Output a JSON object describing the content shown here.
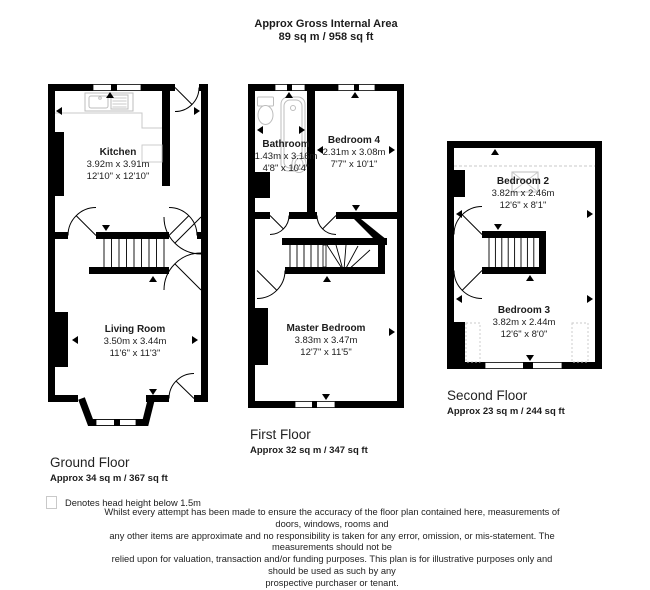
{
  "header": {
    "title": "Approx Gross Internal Area",
    "subtitle": "89 sq m / 958 sq ft"
  },
  "floors": [
    {
      "label": "Ground Floor",
      "area": "Approx 34 sq m / 367 sq ft",
      "rooms": [
        {
          "name": "Kitchen",
          "metric": "3.92m x 3.91m",
          "imperial": "12'10\" x 12'10\""
        },
        {
          "name": "Living Room",
          "metric": "3.50m x 3.44m",
          "imperial": "11'6\" x 11'3\""
        }
      ]
    },
    {
      "label": "First Floor",
      "area": "Approx 32 sq m / 347 sq ft",
      "rooms": [
        {
          "name": "Bathroom",
          "metric": "1.43m x 3.16m",
          "imperial": "4'8\" x 10'4\""
        },
        {
          "name": "Bedroom 4",
          "metric": "2.31m x 3.08m",
          "imperial": "7'7\" x 10'1\""
        },
        {
          "name": "Master Bedroom",
          "metric": "3.83m x 3.47m",
          "imperial": "12'7\" x 11'5\""
        }
      ]
    },
    {
      "label": "Second Floor",
      "area": "Approx 23 sq m / 244 sq ft",
      "rooms": [
        {
          "name": "Bedroom 2",
          "metric": "3.82m x 2.46m",
          "imperial": "12'6\" x 8'1\""
        },
        {
          "name": "Bedroom 3",
          "metric": "3.82m x 2.44m",
          "imperial": "12'6\" x 8'0\""
        }
      ]
    }
  ],
  "legend": {
    "text": "Denotes head height below 1.5m"
  },
  "disclaimer": {
    "lines": [
      "Whilst every attempt has been made to ensure the accuracy of the floor plan contained here, measurements of doors, windows, rooms and",
      "any other items are approximate and no responsibility is taken for any error, omission, or mis-statement. The measurements should not be",
      "relied upon for valuation, transaction and/or funding purposes. This plan is for illustrative purposes only and should be used as such by any",
      "prospective purchaser or tenant."
    ]
  },
  "colors": {
    "wall": "#000000",
    "background": "#ffffff",
    "fixture_gray": "#c8c8c8",
    "dashed_gray": "#c9c9c9"
  }
}
